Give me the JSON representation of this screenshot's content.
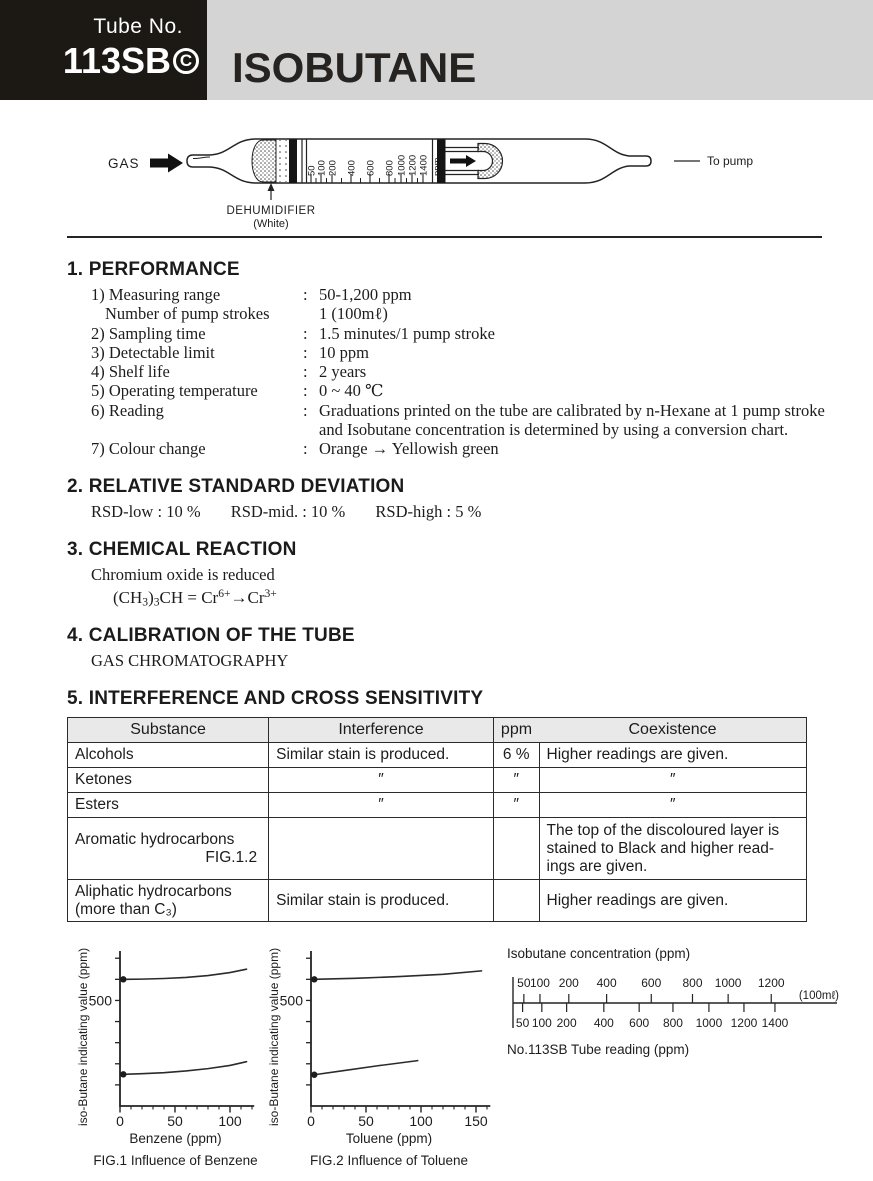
{
  "header": {
    "tube_no_label": "Tube No.",
    "tube_no": "113SB",
    "tube_mark": "C",
    "title": "ISOBUTANE"
  },
  "tube_diagram": {
    "gas_label": "GAS",
    "to_pump_label": "To pump",
    "dehumidifier_label": "DEHUMIDIFIER",
    "dehumidifier_color": "(White)",
    "scale_labels": [
      "50",
      "100",
      "200",
      "400",
      "600",
      "800",
      "1000",
      "1200",
      "1400",
      "ppm"
    ]
  },
  "performance": {
    "heading": "1. PERFORMANCE",
    "items": [
      {
        "label": "1) Measuring range",
        "sep": ":",
        "value": "50-1,200 ppm"
      },
      {
        "label": "Number of pump strokes",
        "sep": "",
        "value": "1 (100mℓ)"
      },
      {
        "label": "2) Sampling time",
        "sep": ":",
        "value": "1.5 minutes/1 pump stroke"
      },
      {
        "label": "3) Detectable limit",
        "sep": ":",
        "value": "10 ppm"
      },
      {
        "label": "4) Shelf life",
        "sep": ":",
        "value": "2 years"
      },
      {
        "label": "5) Operating temperature",
        "sep": ":",
        "value": "0 ~ 40 ℃"
      },
      {
        "label": "6) Reading",
        "sep": ":",
        "value": "Graduations printed on the tube are calibrated by n-Hexane at 1 pump stroke",
        "value2": "and Isobutane concentration is determined by using a conversion chart."
      },
      {
        "label": "7) Colour change",
        "sep": ":",
        "value": "Orange → Yellowish green"
      }
    ]
  },
  "rsd": {
    "heading": "2. RELATIVE STANDARD DEVIATION",
    "items": [
      {
        "label": "RSD-low",
        "sep": ":",
        "value": "10 %"
      },
      {
        "label": "RSD-mid.",
        "sep": ":",
        "value": "10 %"
      },
      {
        "label": "RSD-high",
        "sep": ":",
        "value": "5 %"
      }
    ]
  },
  "chemical": {
    "heading": "3. CHEMICAL REACTION",
    "line1": "Chromium oxide is reduced",
    "formula": {
      "p1": "(CH",
      "sub1": "3",
      "p2": ")",
      "sub2": "3",
      "p3": "CH = Cr",
      "sup1": "6+",
      "p4": "→Cr",
      "sup2": "3+"
    }
  },
  "calibration": {
    "heading": "4. CALIBRATION OF THE TUBE",
    "line1": "GAS CHROMATOGRAPHY"
  },
  "interference": {
    "heading": "5. INTERFERENCE AND CROSS SENSITIVITY",
    "headers": [
      "Substance",
      "Interference",
      "ppm",
      "Coexistence"
    ],
    "rows": [
      {
        "substance": "Alcohols",
        "interference": "Similar stain is produced.",
        "ppm": "6 %",
        "coexistence": "Higher readings are given."
      },
      {
        "substance": "Ketones",
        "interference": "″",
        "ppm": "″",
        "coexistence": "″"
      },
      {
        "substance": "Esters",
        "interference": "″",
        "ppm": "″",
        "coexistence": "″"
      },
      {
        "substance": "Aromatic hydrocarbons",
        "substance2": "FIG.1.2",
        "interference": "",
        "ppm": "",
        "coexistence_lines": [
          "The top of the discoloured layer is",
          "stained to Black and higher read-",
          "ings are given."
        ]
      },
      {
        "substance": "Aliphatic hydrocarbons",
        "substance2": "(more than C₃)",
        "interference": "Similar stain is produced.",
        "ppm": "",
        "coexistence": "Higher readings are given."
      }
    ]
  },
  "chart_data": [
    {
      "id": "fig1",
      "type": "line",
      "title": "FIG.1 Influence of Benzene",
      "xlabel": "Benzene (ppm)",
      "ylabel": "iso-Butane indicating value (ppm)",
      "xlim": [
        0,
        122
      ],
      "ylim": [
        0,
        720
      ],
      "xticks_major": [
        0,
        50,
        100
      ],
      "xtick_minor_step": 10,
      "yticks": [
        100,
        200,
        300,
        400,
        500,
        600,
        700
      ],
      "ytick_labeled": 500,
      "grid": false,
      "legend": "none",
      "series": [
        {
          "name": "upper curve",
          "x": [
            3,
            20,
            40,
            60,
            80,
            100,
            115
          ],
          "y": [
            600,
            601,
            604,
            609,
            618,
            632,
            648
          ]
        },
        {
          "name": "lower curve",
          "x": [
            3,
            20,
            40,
            60,
            80,
            100,
            115
          ],
          "y": [
            150,
            153,
            158,
            166,
            177,
            192,
            210
          ]
        }
      ]
    },
    {
      "id": "fig2",
      "type": "line",
      "title": "FIG.2 Influence of Toluene",
      "xlabel": "Toluene (ppm)",
      "ylabel": "iso-Butane indicating value (ppm)",
      "xlim": [
        0,
        163
      ],
      "ylim": [
        0,
        720
      ],
      "xticks_major": [
        0,
        50,
        100,
        150
      ],
      "xtick_minor_step": 10,
      "yticks": [
        100,
        200,
        300,
        400,
        500,
        600,
        700
      ],
      "ytick_labeled": 500,
      "grid": false,
      "legend": "none",
      "series": [
        {
          "name": "upper curve",
          "x": [
            3,
            40,
            80,
            120,
            155
          ],
          "y": [
            600,
            605,
            613,
            624,
            640
          ]
        },
        {
          "name": "lower curve",
          "x": [
            3,
            30,
            60,
            97
          ],
          "y": [
            148,
            168,
            190,
            215
          ]
        }
      ]
    },
    {
      "id": "conversion-scale",
      "type": "scale",
      "top_label": "Isobutane concentration (ppm)",
      "bottom_label": "No.113SB Tube reading (ppm)",
      "unit_note": "(100mℓ)",
      "top_ticks": [
        {
          "label": "50",
          "pos": 3.5
        },
        {
          "label": "100",
          "pos": 8.7
        },
        {
          "label": "200",
          "pos": 18.0
        },
        {
          "label": "400",
          "pos": 30.2
        },
        {
          "label": "600",
          "pos": 44.6
        },
        {
          "label": "800",
          "pos": 57.9
        },
        {
          "label": "1000",
          "pos": 69.4
        },
        {
          "label": "1200",
          "pos": 83.3
        }
      ],
      "bottom_ticks": [
        {
          "label": "50",
          "pos": 3.1
        },
        {
          "label": "100",
          "pos": 9.3
        },
        {
          "label": "200",
          "pos": 17.3
        },
        {
          "label": "400",
          "pos": 29.3
        },
        {
          "label": "600",
          "pos": 40.7
        },
        {
          "label": "800",
          "pos": 51.6
        },
        {
          "label": "1000",
          "pos": 63.2
        },
        {
          "label": "1200",
          "pos": 74.5
        },
        {
          "label": "1400",
          "pos": 84.5
        }
      ]
    }
  ]
}
